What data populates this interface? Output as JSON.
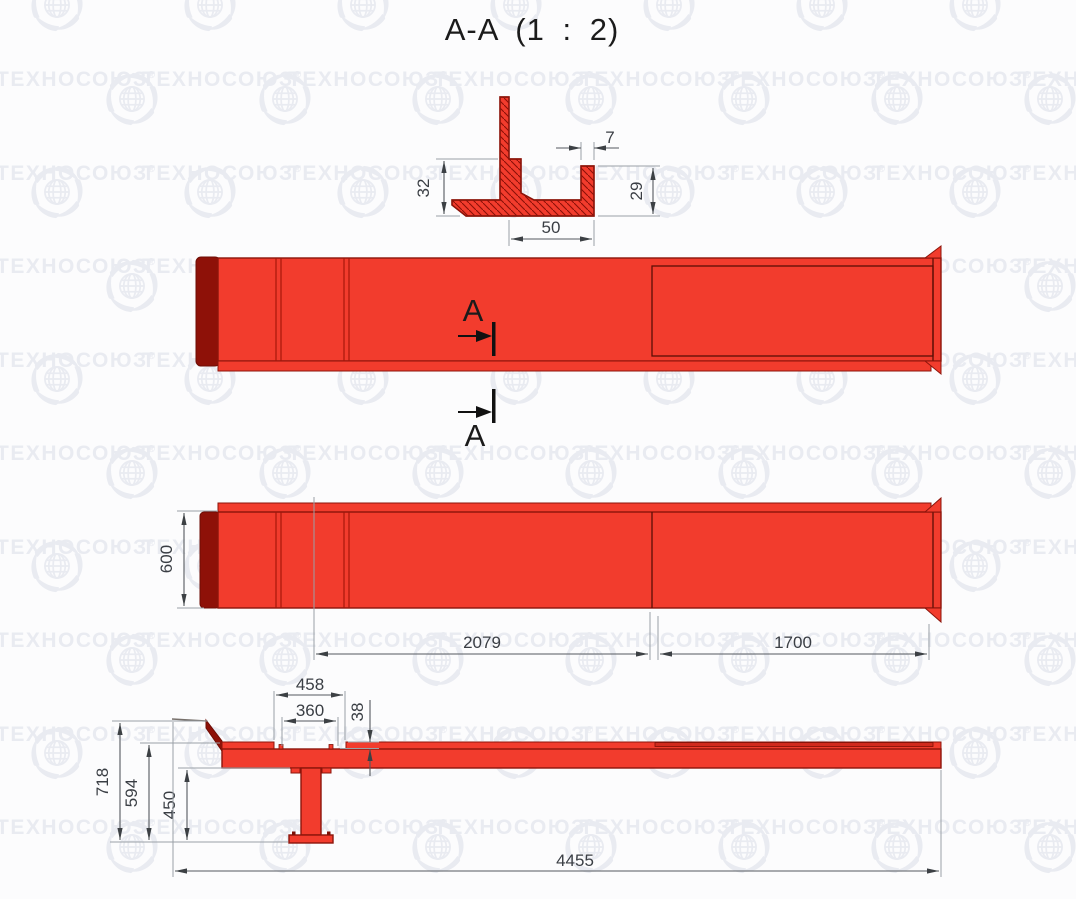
{
  "title": "A-A (1 : 2)",
  "watermark": {
    "text": "ТЕХНОСОЮЗ",
    "registered_mark": "®"
  },
  "section_view": {
    "scale_note": "1 : 2",
    "dim_left_upstand_height": "32",
    "dim_right_flange_width": "7",
    "dim_right_flange_height": "29",
    "dim_channel_width": "50"
  },
  "plan_views": {
    "section_cut_label": "A",
    "dim_beam_width": "600",
    "dim_left_span": "2079",
    "dim_right_span": "1700"
  },
  "side_view": {
    "dim_notch_outer": "458",
    "dim_notch_inner": "360",
    "dim_plate_step": "38",
    "dim_total_height": "718",
    "dim_top_height": "594",
    "dim_leg_height": "450",
    "dim_total_length": "4455"
  },
  "colors": {
    "part_red": "#F23C2D",
    "part_dark_red": "#8E1108",
    "outline_red": "#8C150B",
    "dim_line": "#55595e",
    "ext_line": "#9aa0a6",
    "text_dark": "#1b1b1b",
    "watermark": "#E9EBF1"
  }
}
